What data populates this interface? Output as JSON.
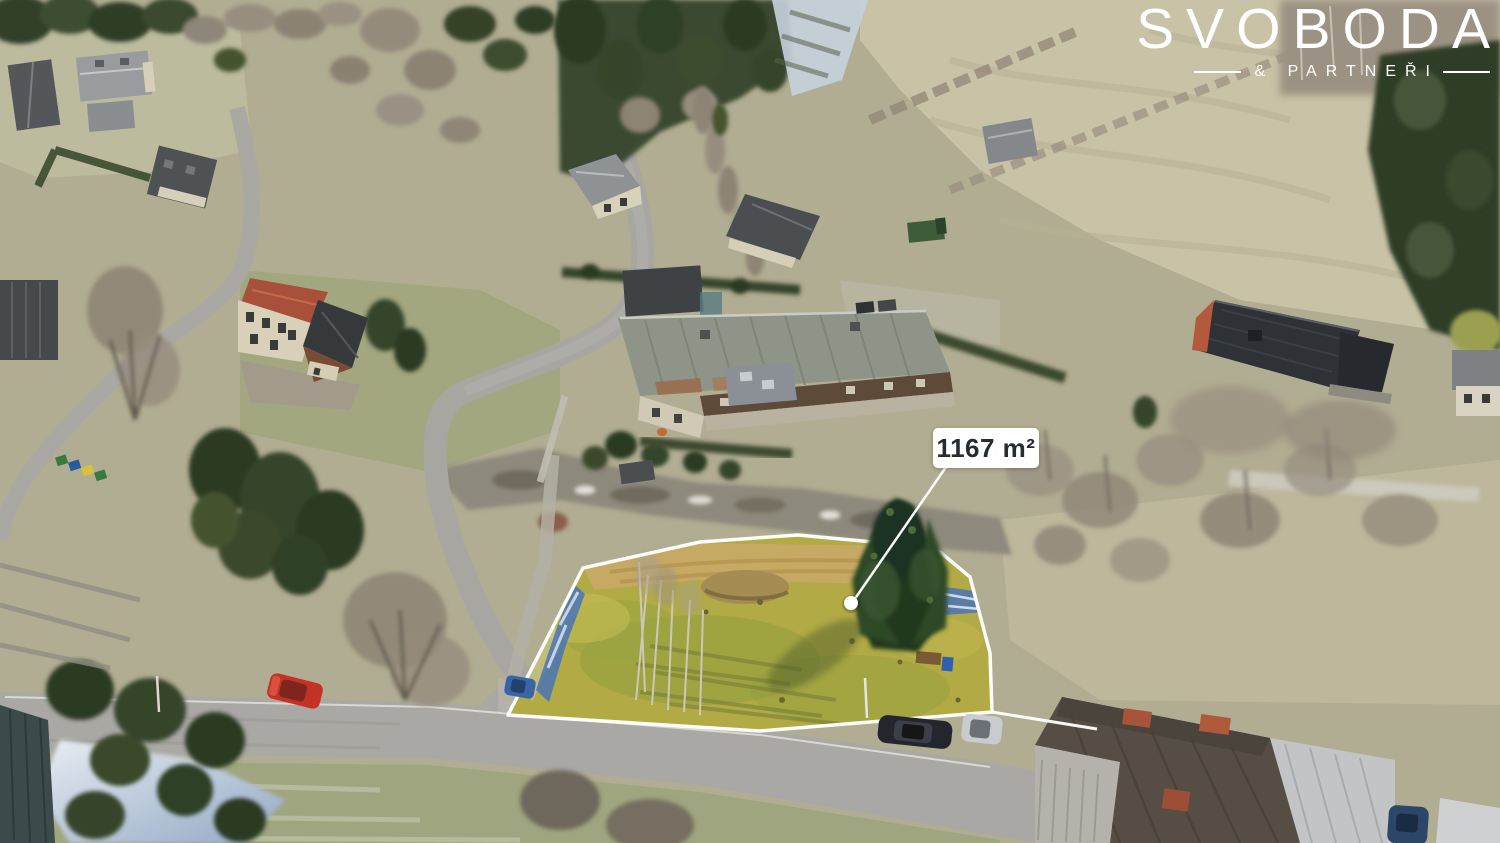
{
  "brand": {
    "name": "SVOBODA",
    "tagline": "& PARTNEŘI"
  },
  "annotation": {
    "area_label": "1167 m²"
  },
  "colors": {
    "annotation_white": "#ffffff",
    "label_background": "#ffffff",
    "label_text": "#272c33",
    "logo_text": "#ffffff",
    "plot_highlight_grass": "#b1aa45",
    "plot_outline": "#ffffff"
  }
}
